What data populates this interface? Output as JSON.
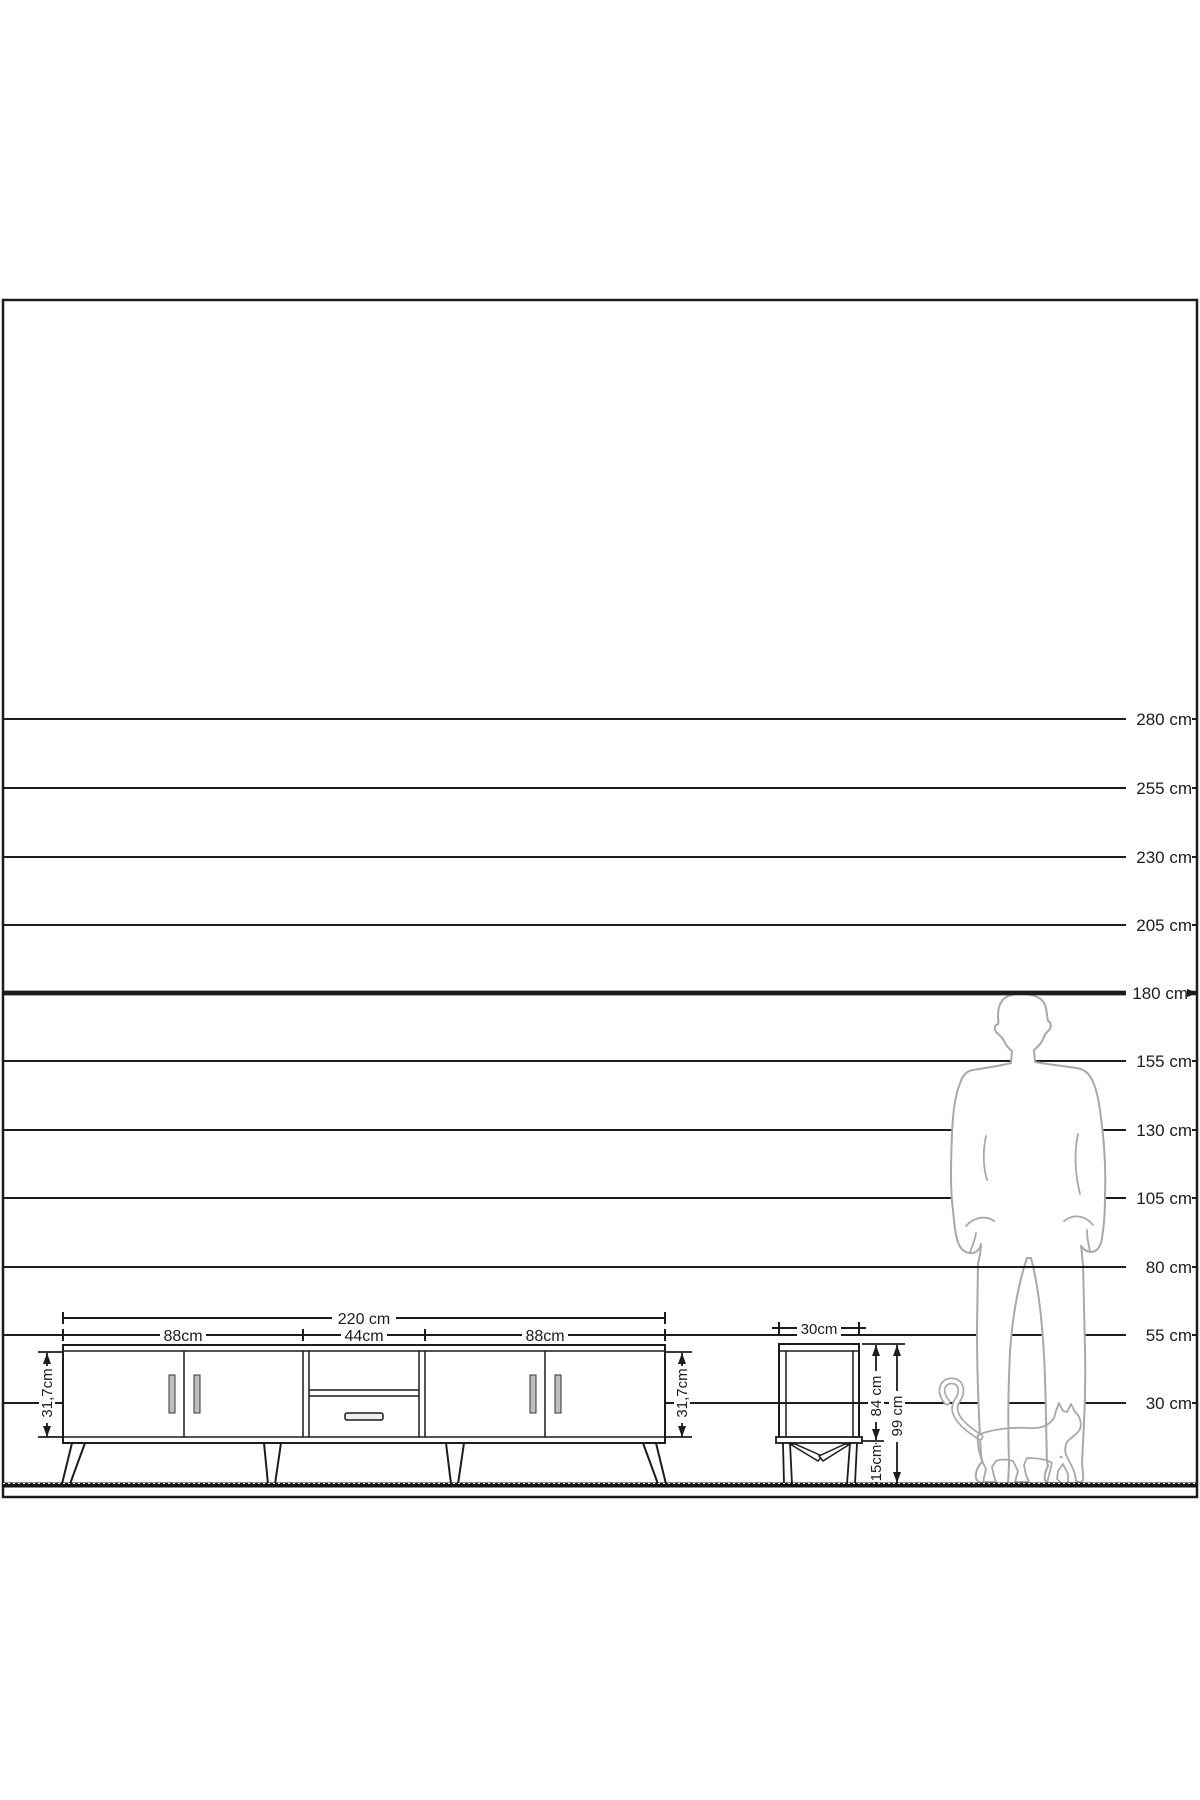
{
  "scale": {
    "labels": [
      "280 cm",
      "255 cm",
      "230 cm",
      "205 cm",
      "180 cm",
      "155 cm",
      "130 cm",
      "105 cm",
      "80 cm",
      "55 cm",
      "30 cm"
    ]
  },
  "tv_stand": {
    "width_total": "220 cm",
    "section_left": "88cm",
    "section_middle": "44cm",
    "section_right": "88cm",
    "height_left": "31,7cm",
    "height_right": "31,7cm"
  },
  "side_table": {
    "width": "30cm",
    "body_height": "84 cm",
    "leg_height": "15cm",
    "total_height": "99 cm"
  }
}
